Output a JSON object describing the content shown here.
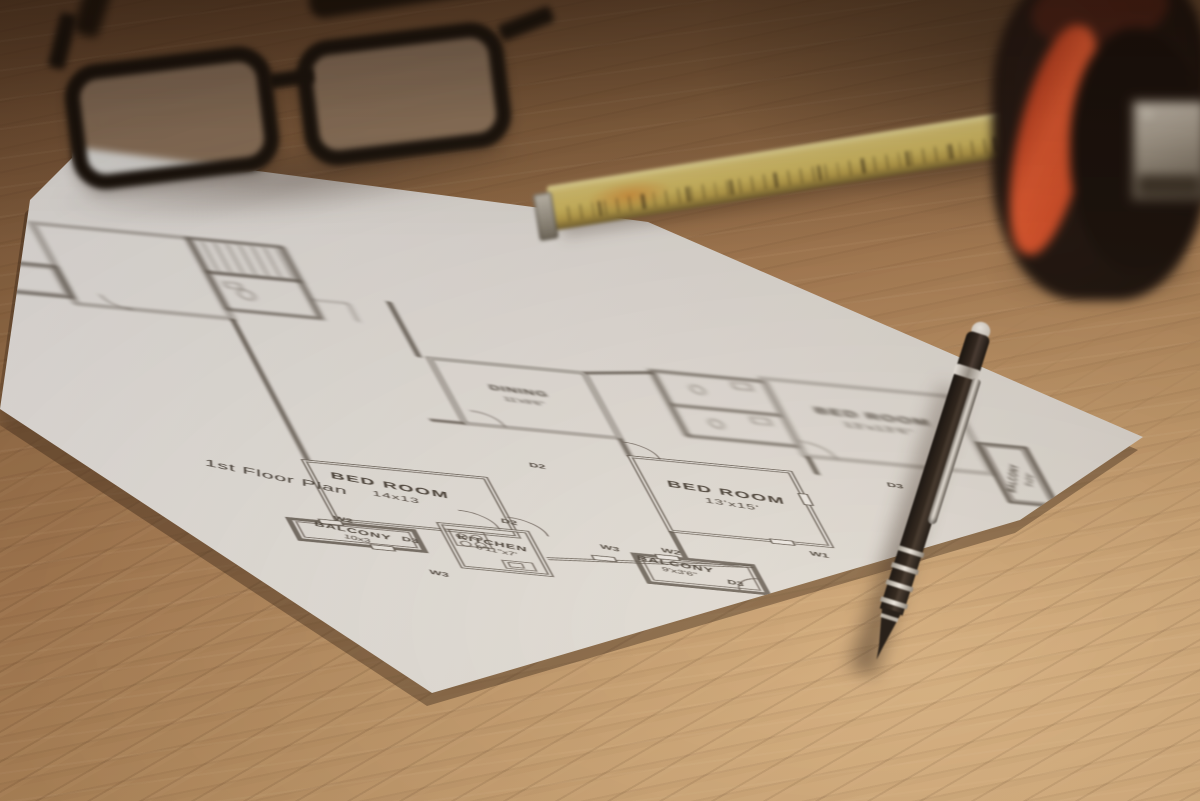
{
  "scene": {
    "plan": {
      "title": "1st Floor Plan",
      "rooms": {
        "bedroom_left": {
          "name": "BED ROOM",
          "dims": "14x13"
        },
        "balcony_left": {
          "name": "BALCONY",
          "dims": "10x3"
        },
        "kitchen": {
          "name": "KITCHEN",
          "dims": "6'11\"x7'"
        },
        "dining": {
          "name": "DINING",
          "dims": "11'x9'6\""
        },
        "bedroom_right": {
          "name": "BED ROOM",
          "dims": "13'x15'"
        },
        "balcony_right": {
          "name": "BALCONY",
          "dims": "9'x3'6\""
        },
        "bedroom_top_right": {
          "name": "BED ROOM",
          "dims": "13'x13'6\""
        },
        "balcony_far_right": {
          "name": "BALCONY",
          "dims": "9'x3'6\""
        }
      },
      "tags": {
        "d2a": "D2",
        "d2b": "D2",
        "d3a": "D3",
        "d3b": "D3",
        "d3c": "D3",
        "w1": "W1",
        "w2a": "W2",
        "w2b": "W2",
        "w3a": "W3",
        "w3b": "W3"
      }
    },
    "colors": {
      "wood_dark": "#7a573b",
      "wood_mid": "#a07751",
      "wood_light": "#c79e70",
      "paper": "#e8e5e1",
      "ink": "#4a443e",
      "tape_blade_yellow": "#d9c568",
      "tape_body_black": "#1a1210",
      "tape_body_orange": "#de4f2b",
      "pen_black": "#1a1410",
      "pen_silver": "#cfc9c3",
      "glasses_black": "#181008"
    }
  }
}
